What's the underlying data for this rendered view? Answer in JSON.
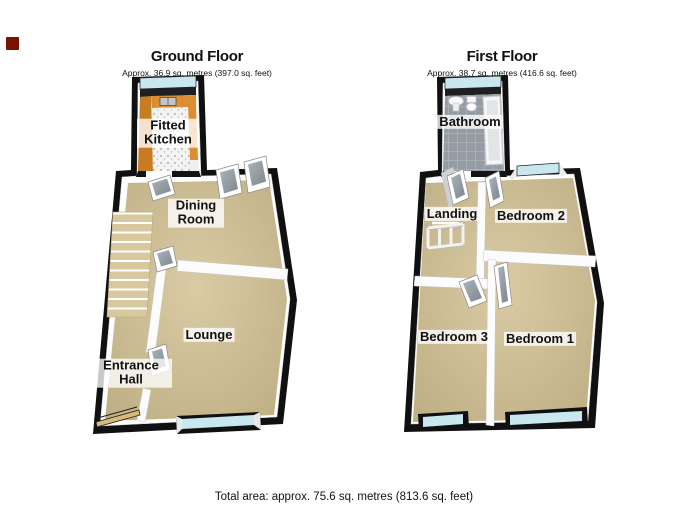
{
  "ground_floor": {
    "title": "Ground Floor",
    "subtitle": "Approx. 36.9 sq. metres (397.0 sq. feet)",
    "rooms": {
      "kitchen": "Fitted Kitchen",
      "dining": "Dining Room",
      "lounge": "Lounge",
      "hall": "Entrance Hall"
    }
  },
  "first_floor": {
    "title": "First Floor",
    "subtitle": "Approx. 38.7 sq. metres (416.6 sq. feet)",
    "rooms": {
      "bathroom": "Bathroom",
      "landing": "Landing",
      "bedroom2": "Bedroom 2",
      "bedroom3": "Bedroom 3",
      "bedroom1": "Bedroom 1"
    }
  },
  "footer": {
    "total_area": "Total area: approx. 75.6 sq. metres (813.6 sq. feet)"
  },
  "colors": {
    "logo_red": "#7c1204",
    "floor_tan": "#cdbd93",
    "wall_white": "#fdfdfd",
    "outline_black": "#101010",
    "window_blue": "#c9e7ee",
    "counter_orange": "#dd8e33",
    "wood_orange": "#c87c22",
    "bathroom_gray": "#959ca4",
    "stair_tan": "#d8c89e"
  }
}
